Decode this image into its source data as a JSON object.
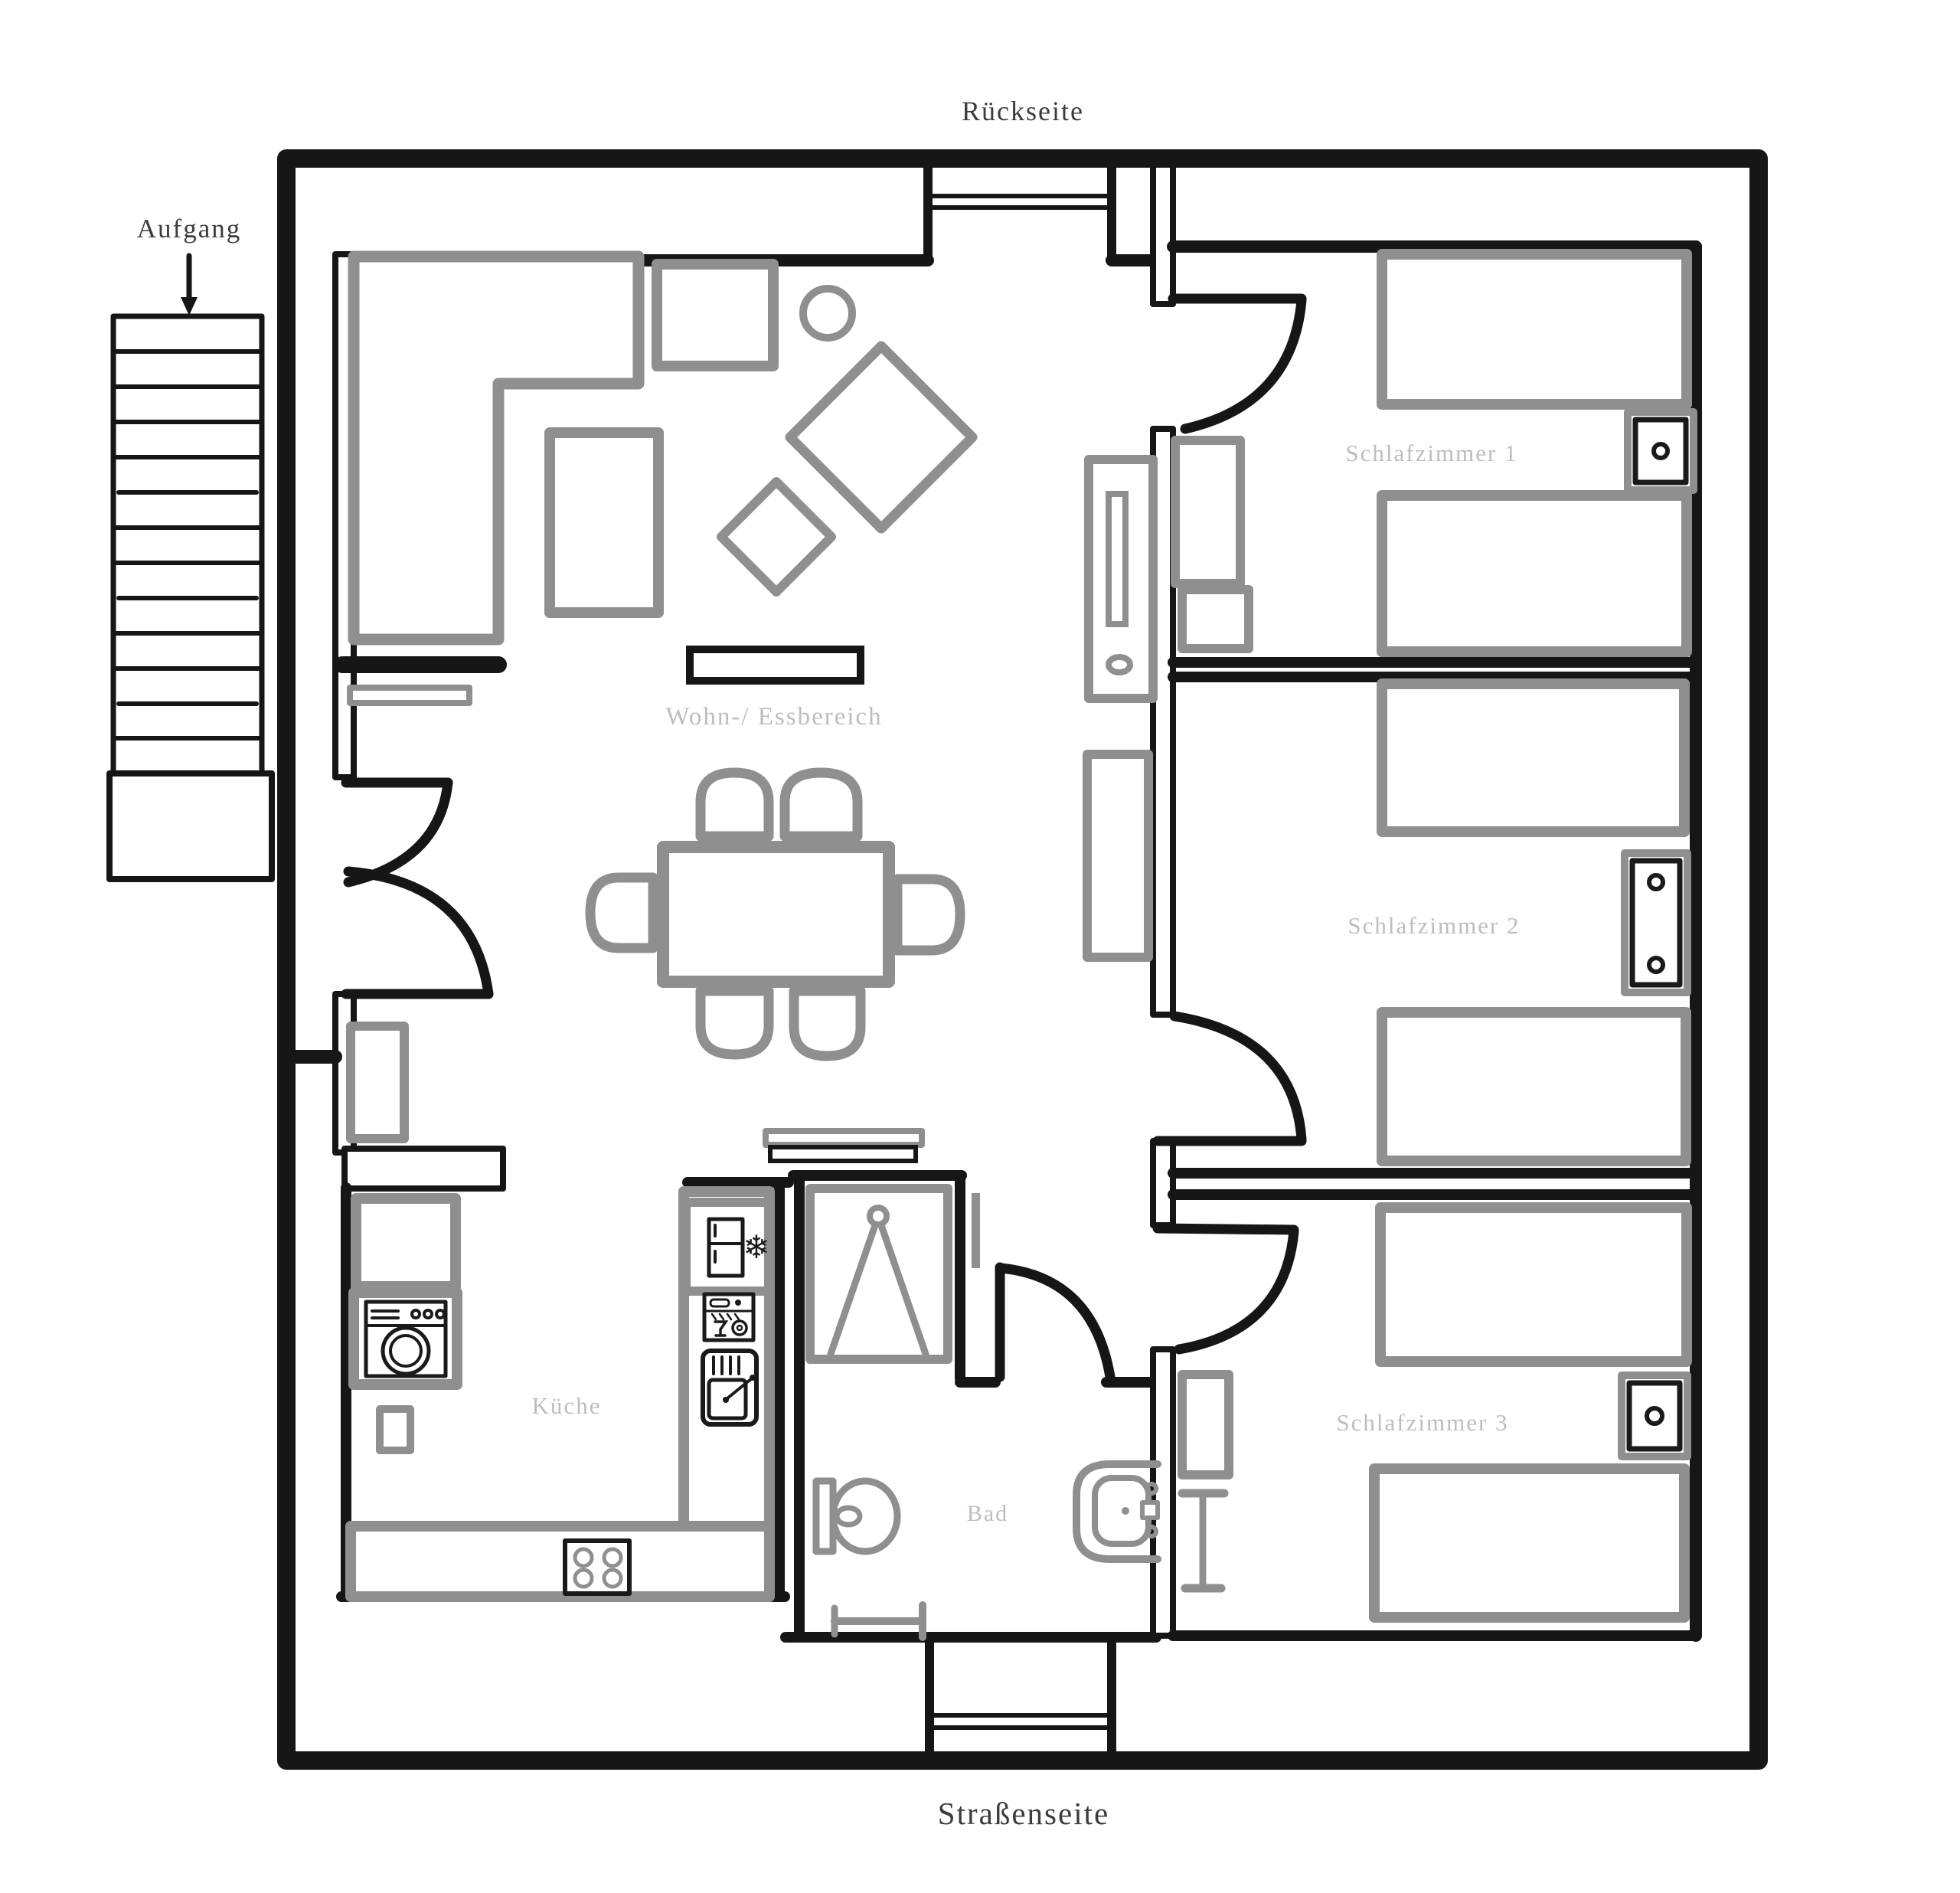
{
  "plan": {
    "title_back": "Rückseite",
    "title_front": "Straßenseite",
    "stairs_label": "Aufgang",
    "rooms": {
      "living": {
        "label": "Wohn-/ Essbereich"
      },
      "kitchen": {
        "label": "Küche"
      },
      "bath": {
        "label": "Bad"
      },
      "bedroom1": {
        "label": "Schlafzimmer 1"
      },
      "bedroom2": {
        "label": "Schlafzimmer 2"
      },
      "bedroom3": {
        "label": "Schlafzimmer 3"
      }
    },
    "icons": {
      "snowflake": "❄"
    },
    "colors": {
      "wall": "#161616",
      "furniture": "#8f8f8f",
      "room_label": "#bdbdbd",
      "outside_label": "#3c3c3c"
    }
  }
}
